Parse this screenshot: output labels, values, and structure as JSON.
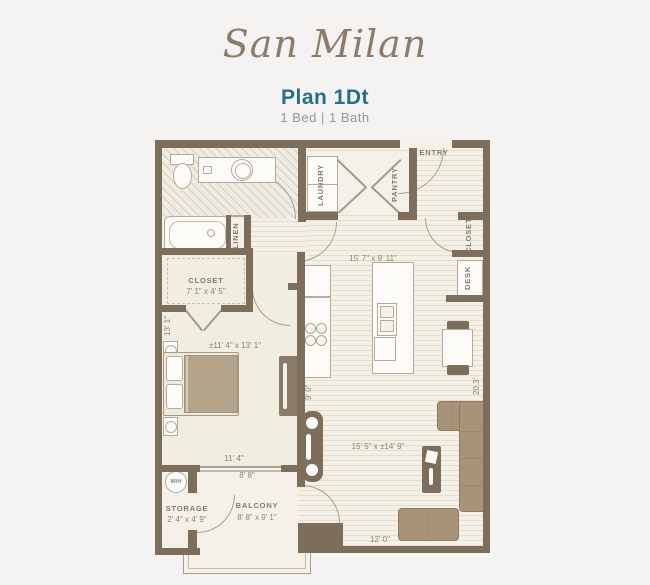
{
  "header": {
    "brand": "San Milan",
    "plan_name": "Plan 1Dt",
    "specs": "1 Bed | 1 Bath"
  },
  "plan": {
    "entry": {
      "label": "ENTRY"
    },
    "laundry": {
      "label": "LAUNDRY"
    },
    "pantry": {
      "label": "PANTRY"
    },
    "entry_closet": {
      "label": "CLOSET"
    },
    "desk": {
      "label": "DESK"
    },
    "linen": {
      "label": "LINEN"
    },
    "bedroom_closet": {
      "label": "CLOSET",
      "dims": "7' 1\" x 4' 5\""
    },
    "bedroom": {
      "dims": "±11' 4\" x 13' 1\"",
      "width": "11' 4\"",
      "depth": "13' 1\""
    },
    "kitchen": {
      "dims": "15' 7\" x 9' 11\"",
      "depth": "9' 0\""
    },
    "living": {
      "dims": "15' 5\" x ±14' 9\"",
      "width": "12' 0\"",
      "depth": "20.3'"
    },
    "storage": {
      "label": "STORAGE",
      "dims": "2' 4\" x 4' 9\""
    },
    "balcony": {
      "label": "BALCONY",
      "dims": "8' 8\" x 9' 1\"",
      "width": "8' 8\""
    },
    "water_heater": {
      "label": "W/H"
    }
  },
  "colors": {
    "wall": "#7d6e5c",
    "accent_teal": "#266f87",
    "brand_text": "#8c7c69",
    "furniture_tan": "#a79478",
    "floor_cream": "#f4f0e6",
    "label_text": "#857b6b"
  }
}
